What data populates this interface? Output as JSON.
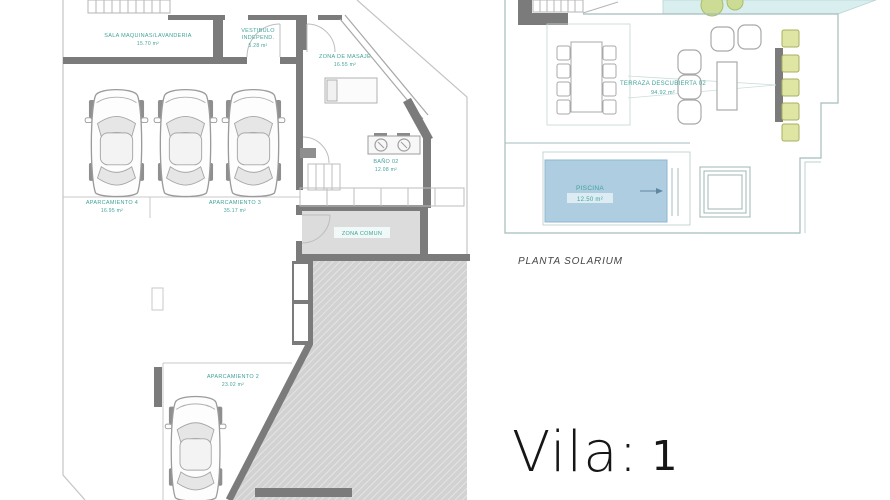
{
  "sheet": {
    "type": "architectural-floor-plan"
  },
  "plans": {
    "basement": {
      "rooms": {
        "sala_maquinas": {
          "name": "SALA MAQUINAS/LAVANDERIA",
          "area": "15.70 m²"
        },
        "vestibulo": {
          "name_line1": "VESTIBULO",
          "name_line2": "INDEPEND.",
          "area": "5.28 m²"
        },
        "zona_masaje": {
          "name": "ZONA DE MASAJE",
          "area": "16.55 m²"
        },
        "bano_02": {
          "name": "BAÑO 02",
          "area": "12.08 m²"
        },
        "aparcamiento_4": {
          "name": "APARCAMIENTO 4",
          "area": "16.95 m²"
        },
        "aparcamiento_3": {
          "name": "APARCAMIENTO 3",
          "area": "35.17 m²"
        },
        "aparcamiento_2": {
          "name": "APARCAMIENTO 2",
          "area": "23.02 m²"
        },
        "zona_comun": {
          "name": "ZONA COMUN"
        }
      }
    },
    "solarium": {
      "caption": "PLANTA SOLARIUM",
      "rooms": {
        "terraza": {
          "name": "TERRAZA DESCUBIERTA 02",
          "area": "94.92 m²"
        },
        "piscina": {
          "name": "PISCINA",
          "area": "12.50 m²"
        }
      }
    }
  },
  "footer": {
    "brand": "Vila:",
    "number": "1"
  },
  "colors": {
    "label_teal": "#41a39a",
    "wall_gray": "#7b7b7b",
    "pool_blue": "#aecde1",
    "lounger_yellow": "#dfe5a3",
    "terrace_cyan": "#d9eeee",
    "hatch_gray": "#d2d2d2"
  }
}
